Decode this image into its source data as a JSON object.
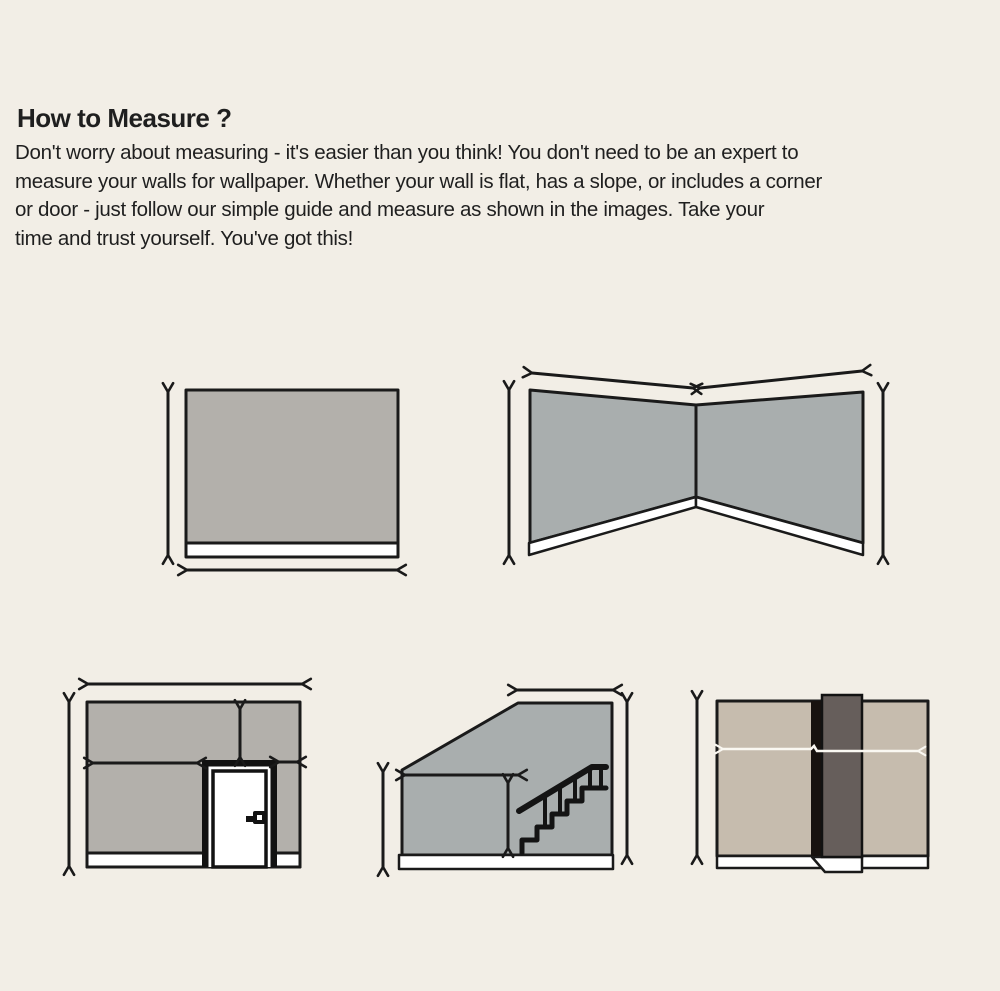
{
  "header": {
    "title": "How to Measure ?",
    "body_lines": [
      "Don't worry about measuring - it's easier than you think! You don't need to be an expert to",
      "measure your walls for wallpaper. Whether your wall is flat, has a slope, or includes a corner",
      "or door - just follow our simple guide and measure as shown in the images. Take your",
      "time and trust yourself. You've got this!"
    ]
  },
  "colors": {
    "background": "#f2eee6",
    "text": "#1f1f1f",
    "outline": "#1a1a1a",
    "wall_gray": "#b3b0ab",
    "wall_cool_gray": "#a9aeae",
    "wall_beige": "#c6bcae",
    "column_dark": "#665e5b",
    "column_shadow": "#17120f",
    "baseboard_white": "#ffffff",
    "arrow_white": "#faf8f2"
  },
  "diagrams": [
    {
      "name": "flat-wall"
    },
    {
      "name": "corner-wall"
    },
    {
      "name": "wall-with-door"
    },
    {
      "name": "sloped-wall-with-staircase"
    },
    {
      "name": "wall-with-column"
    }
  ]
}
